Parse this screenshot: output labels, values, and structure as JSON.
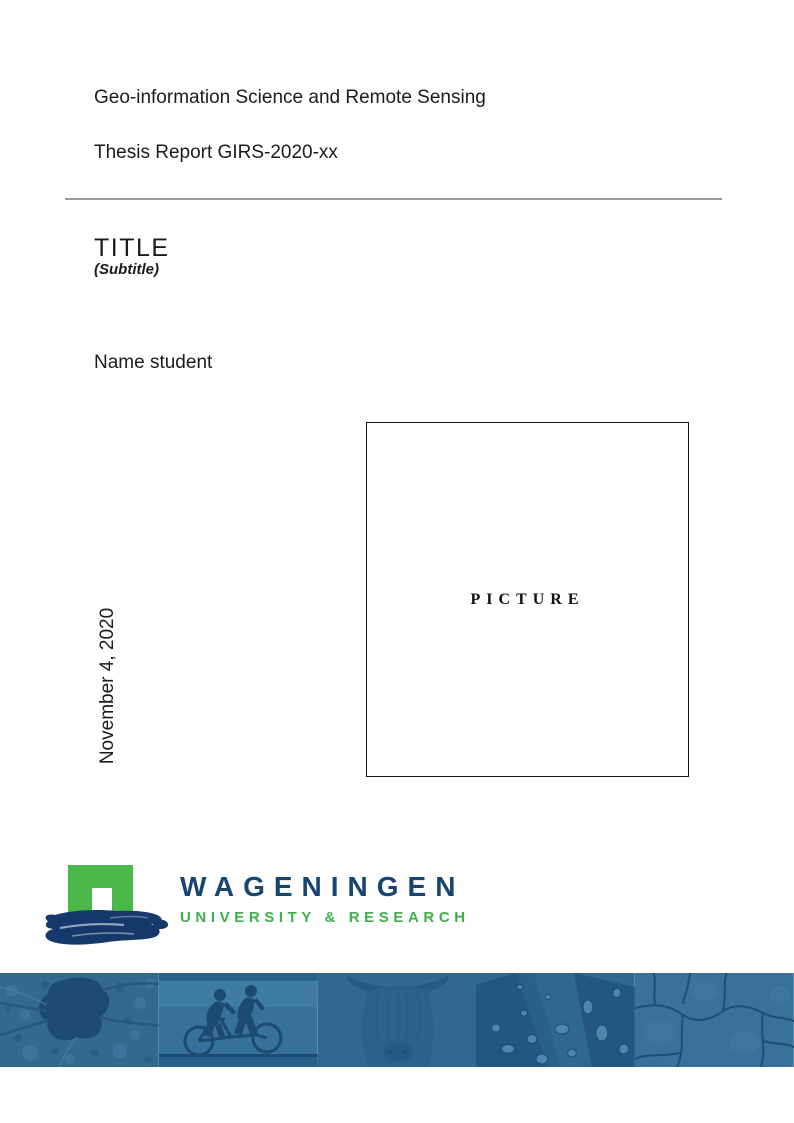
{
  "document": {
    "department": "Geo-information Science and Remote Sensing",
    "report_line": "Thesis Report GIRS-2020-xx",
    "title": "TITLE",
    "subtitle": "(Subtitle)",
    "author": "Name student",
    "date": "November 4, 2020",
    "picture_placeholder": "PICTURE"
  },
  "logo": {
    "brand": "WAGENINGEN",
    "tagline": "UNIVERSITY & RESEARCH",
    "colors": {
      "arch_green": "#4cb848",
      "tagline_green": "#3db04a",
      "brand_navy": "#18456f",
      "brush_navy": "#16396b"
    }
  },
  "footer_banner": {
    "base_color": "#31688f",
    "silhouette_color": "#1d4a70",
    "images": [
      {
        "name": "aerial-map"
      },
      {
        "name": "tandem-cyclists"
      },
      {
        "name": "highland-cow"
      },
      {
        "name": "leaf-droplets"
      },
      {
        "name": "cracked-earth"
      }
    ]
  },
  "divider_color": "#9a9a9a"
}
